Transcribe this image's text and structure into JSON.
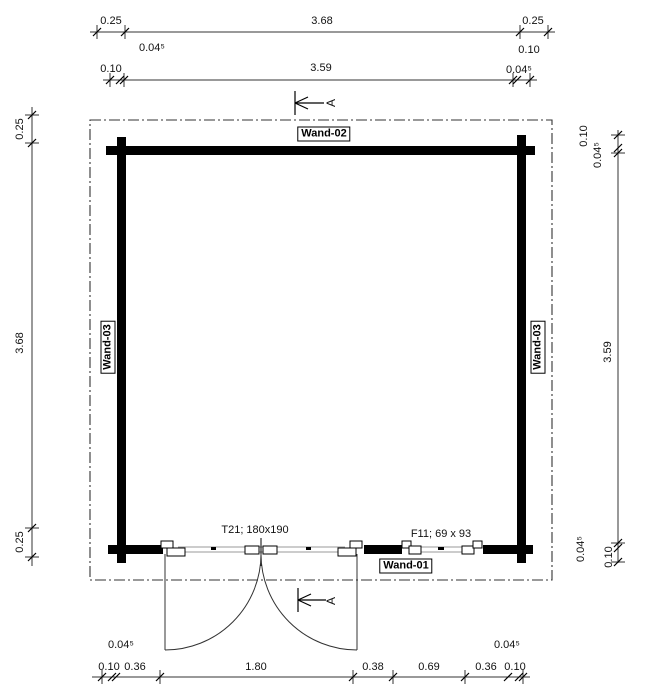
{
  "walls": {
    "top": "Wand-02",
    "bottom": "Wand-01",
    "left": "Wand-03",
    "right": "Wand-03"
  },
  "openings": {
    "door": "T21; 180x190",
    "window": "F11; 69 x 93"
  },
  "section": {
    "top": "A",
    "bottom": "A"
  },
  "dims": {
    "top_outer": [
      "0.25",
      "3.68",
      "0.25"
    ],
    "top_inner": [
      "0.10",
      "3.59",
      "0.04⁵"
    ],
    "top_inner_sub": [
      "0.04⁵",
      "0.10"
    ],
    "left": [
      "0.25",
      "3.68",
      "0.25"
    ],
    "right": [
      "0.10",
      "0.04⁵",
      "3.59",
      "0.04⁵",
      "0.10"
    ],
    "bottom": [
      "0.10",
      "0.36",
      "1.80",
      "0.38",
      "0.69",
      "0.36",
      "0.10"
    ],
    "bottom_sub": [
      "0.04⁵",
      "0.04⁵"
    ]
  },
  "colors": {
    "wall": "#000000",
    "dim_line": "#333333",
    "sill": "#999999"
  }
}
